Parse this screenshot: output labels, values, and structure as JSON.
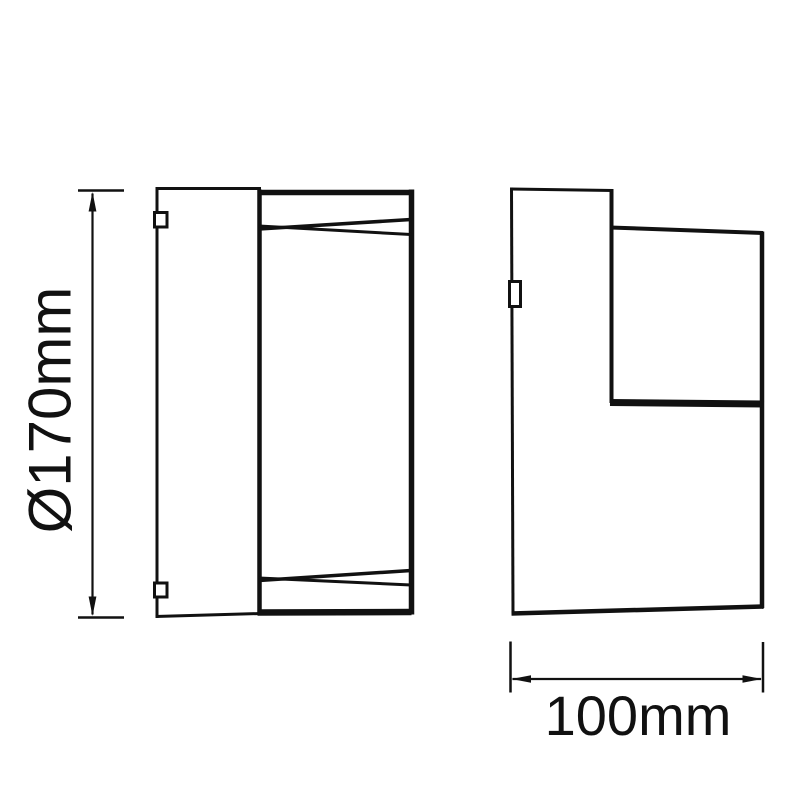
{
  "page": {
    "background_color": "#ffffff",
    "line_color": "#111111",
    "text_color": "#111111"
  },
  "drawing": {
    "dimensions": {
      "height": {
        "label": "Ø170mm"
      },
      "depth": {
        "label": "100mm"
      }
    }
  }
}
